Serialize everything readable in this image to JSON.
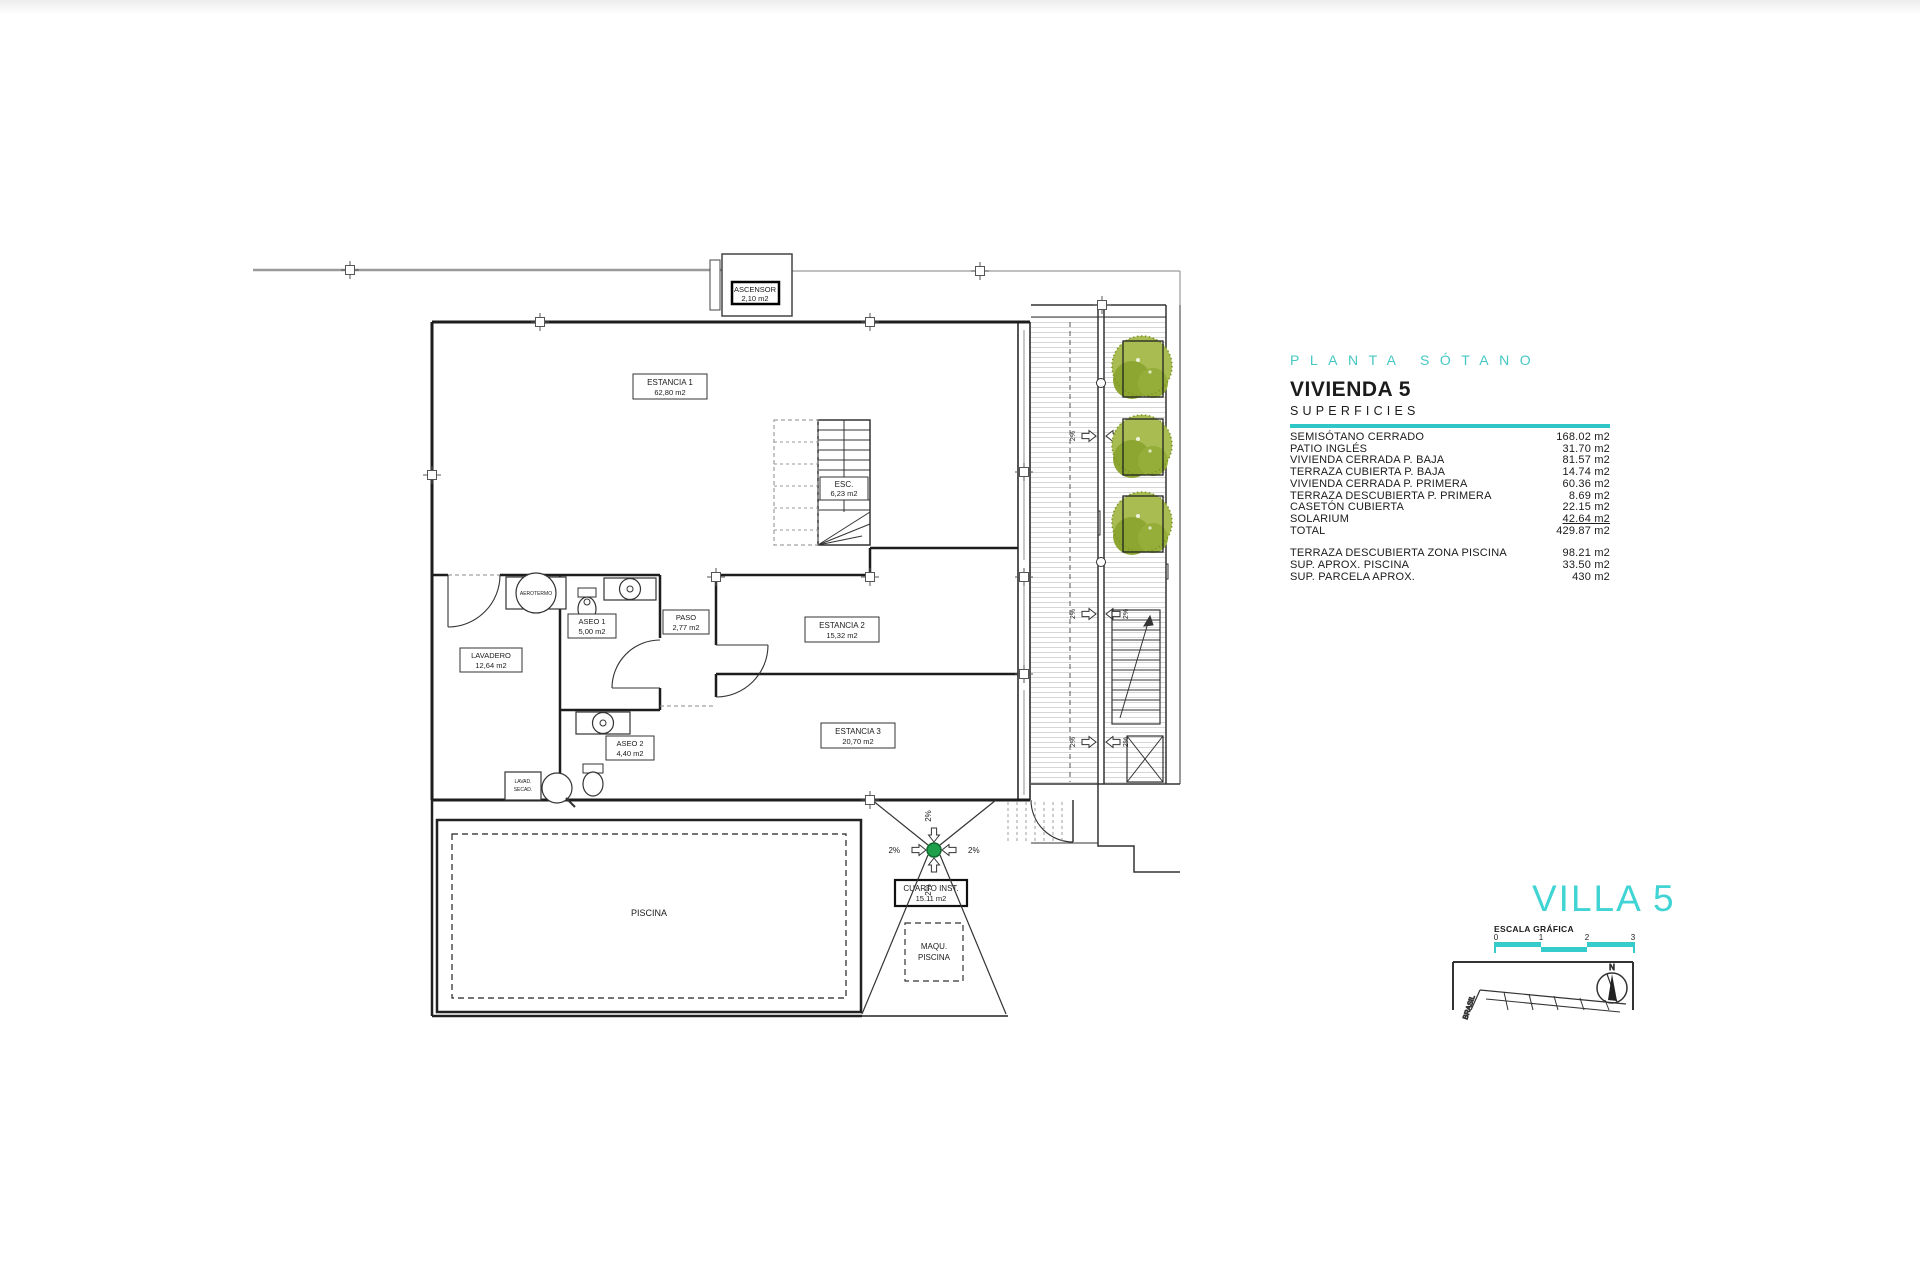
{
  "panel": {
    "title": "PLANTA SÓTANO",
    "heading": "VIVIENDA 5",
    "subheading": "SUPERFICIES",
    "rows": [
      {
        "label": "SEMISÓTANO CERRADO",
        "value": "168.02 m2"
      },
      {
        "label": "PATIO INGLÉS",
        "value": "31.70 m2"
      },
      {
        "label": "VIVIENDA CERRADA P. BAJA",
        "value": "81.57 m2"
      },
      {
        "label": "TERRAZA CUBIERTA P. BAJA",
        "value": "14.74 m2"
      },
      {
        "label": "VIVIENDA CERRADA P. PRIMERA",
        "value": "60.36 m2"
      },
      {
        "label": "TERRAZA DESCUBIERTA P. PRIMERA",
        "value": "8.69 m2"
      },
      {
        "label": "CASETÓN CUBIERTA",
        "value": "22.15 m2"
      },
      {
        "label": "SOLARIUM",
        "value": "42.64 m2"
      },
      {
        "label": "TOTAL",
        "value": "429.87 m2"
      }
    ],
    "extra_rows": [
      {
        "label": "TERRAZA DESCUBIERTA  ZONA PISCINA",
        "value": "98.21 m2"
      },
      {
        "label": "SUP.  APROX.  PISCINA",
        "value": "33.50 m2"
      },
      {
        "label": "SUP. PARCELA APROX.",
        "value": "430 m2"
      }
    ]
  },
  "villa": {
    "title": "VILLA 5",
    "scale_label": "ESCALA GRÁFICA",
    "ticks": [
      "0",
      "1",
      "2",
      "3"
    ],
    "north": "N",
    "street": "BRASIL"
  },
  "plan": {
    "slope": "2%",
    "ascensor_name": "ASCENSOR",
    "ascensor_area": "2,10 m2",
    "estancia1_name": "ESTANCIA 1",
    "estancia1_area": "62,80 m2",
    "esc_name": "ESC.",
    "esc_area": "6,23 m2",
    "estancia2_name": "ESTANCIA 2",
    "estancia2_area": "15,32 m2",
    "estancia3_name": "ESTANCIA 3",
    "estancia3_area": "20,70 m2",
    "paso_name": "PASO",
    "paso_area": "2,77 m2",
    "aseo1_name": "ASEO 1",
    "aseo1_area": "5,00 m2",
    "aseo2_name": "ASEO 2",
    "aseo2_area": "4,40 m2",
    "lavadero_name": "LAVADERO",
    "lavadero_area": "12,64 m2",
    "piscina_name": "PISCINA",
    "cuarto_name": "CUARTO INST.",
    "cuarto_area": "15.11 m2",
    "maqu_line1": "MAQU.",
    "maqu_line2": "PISCINA",
    "patio_cub_name": "PATIO CUB.",
    "patio_cub_area": "50%=5,01 m2",
    "patio_ingles_name": "PATIO INGLES",
    "aerotermo_name": "AEROTERMO",
    "lavad_line1": "LAVAD.",
    "lavad_line2": "SECAD."
  },
  "colors": {
    "accent": "#35cccb",
    "tree": "#8ca631",
    "drain": "#1ea04b"
  }
}
